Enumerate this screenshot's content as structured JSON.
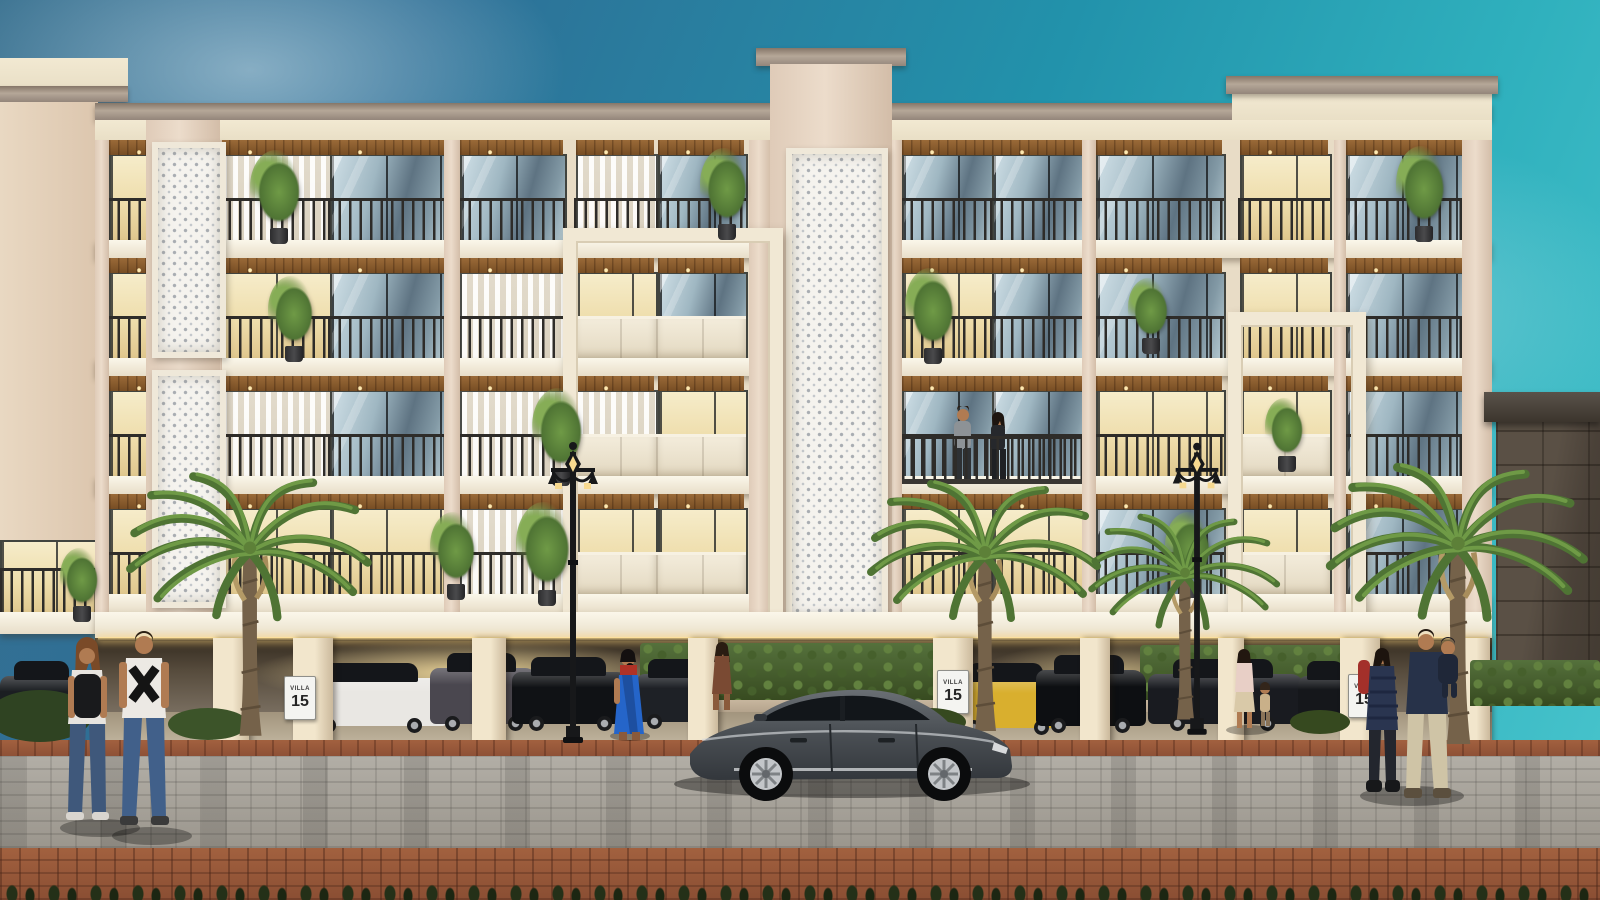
{
  "meta": {
    "description": "Architectural rendering: front elevation of a four-storey cream and blush residential building with recessed balconies, black metal railings, wooden soffits, white perforated jali screens and stilt parking below; palm trees, ornate street lamps, parked cars, a grey sedan on a paver road and pedestrians in the foreground under a blue-teal sky."
  },
  "signs": [
    {
      "top": "VILLA",
      "number": "15"
    },
    {
      "top": "VILLA",
      "number": "15"
    },
    {
      "top": "VILLA",
      "number": "15"
    }
  ],
  "colors": {
    "sky1": "#2e6f96",
    "sky2": "#2292ab",
    "sky3": "#49c5cd",
    "cream": "#f2e9d2",
    "cornice": "#97887c",
    "wall": "#ecdccb",
    "wood1": "#9a6a38",
    "wood2": "#774d24",
    "rail": "#2e2c29",
    "glassA": "#cfdfe6",
    "glassB": "#5e7382",
    "warmA": "#f6ecca",
    "warmB": "#dfc68c",
    "jalibg": "#f5f3ee",
    "jalidot": "#a9adb2",
    "parkmid": "#7d7264",
    "hedge1": "#55713c",
    "hedge2": "#36491f",
    "roadA": "#b2aea6",
    "roadB": "#9b968d",
    "terra1": "#a2613f",
    "terra2": "#8a4e33",
    "stone1": "#5a5045",
    "stone2": "#433b32",
    "car_grey": "#53585d",
    "car_white": "#e9e7e3",
    "car_yellow": "#d9af2e",
    "car_black": "#101215",
    "palm_dark": "#4f7434",
    "palm_light": "#6f9a46",
    "trunk": "#75624a"
  },
  "scene": {
    "building": "four floors of balconies over stilt parking, central jali tower, projecting white frame boxes",
    "people": [
      "couple walking away holding hands: woman with black backpack and jeans, man in white t-shirt with black X graphic",
      "woman in blue sari with red blouse walking through parking",
      "woman in brown dress behind grey sedan",
      "woman with small child beside right street lamp",
      "family on right: man in navy jacket carrying child, woman in navy puffer coat",
      "man and woman chatting on third-floor balcony"
    ],
    "vehicles": [
      "dark grey sedan in road foreground",
      "white sedan, dark SUVs and black hatchback parked under building",
      "yellow coupe parked under building right side"
    ],
    "landscape": [
      "four palm trees",
      "hedges in parking",
      "two ornate black street lamps",
      "dark stone gate pillar right",
      "grey paver road with terracotta brick foreground"
    ]
  }
}
